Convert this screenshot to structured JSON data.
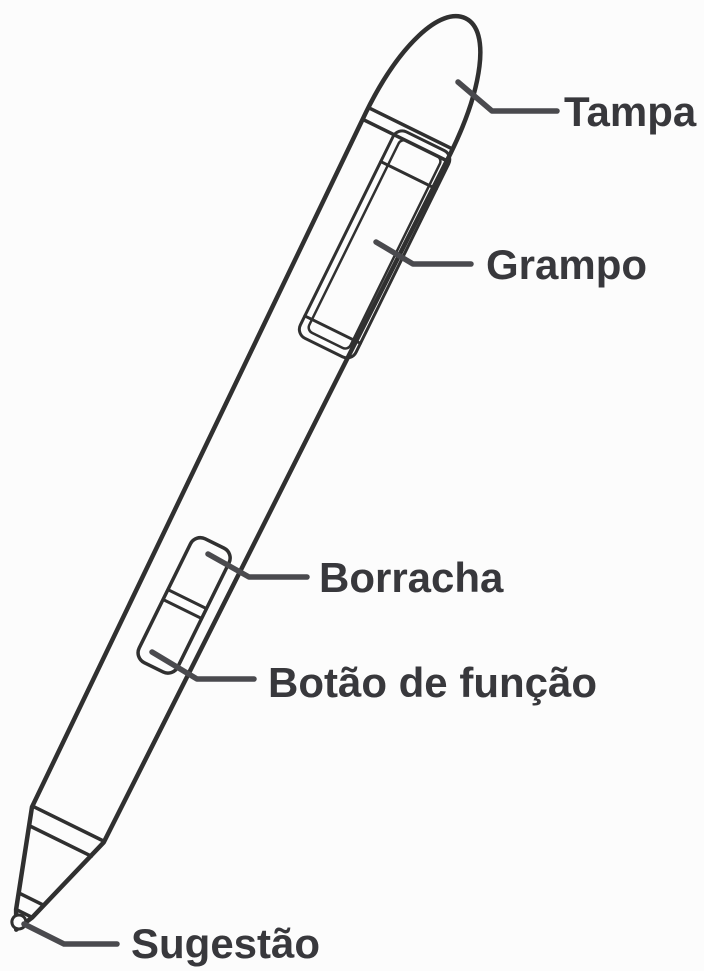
{
  "diagram": {
    "subject": "stylus-pen-parts",
    "labels": [
      {
        "id": "tampa",
        "text": "Tampa"
      },
      {
        "id": "grampo",
        "text": "Grampo"
      },
      {
        "id": "borracha",
        "text": "Borracha"
      },
      {
        "id": "botao",
        "text": "Botão de função"
      },
      {
        "id": "sugestao",
        "text": "Sugestão"
      }
    ],
    "colors": {
      "background": "#fcfcfc",
      "outline": "#303030",
      "leader_line": "#4a4a4e",
      "label_text": "#38383c"
    }
  }
}
